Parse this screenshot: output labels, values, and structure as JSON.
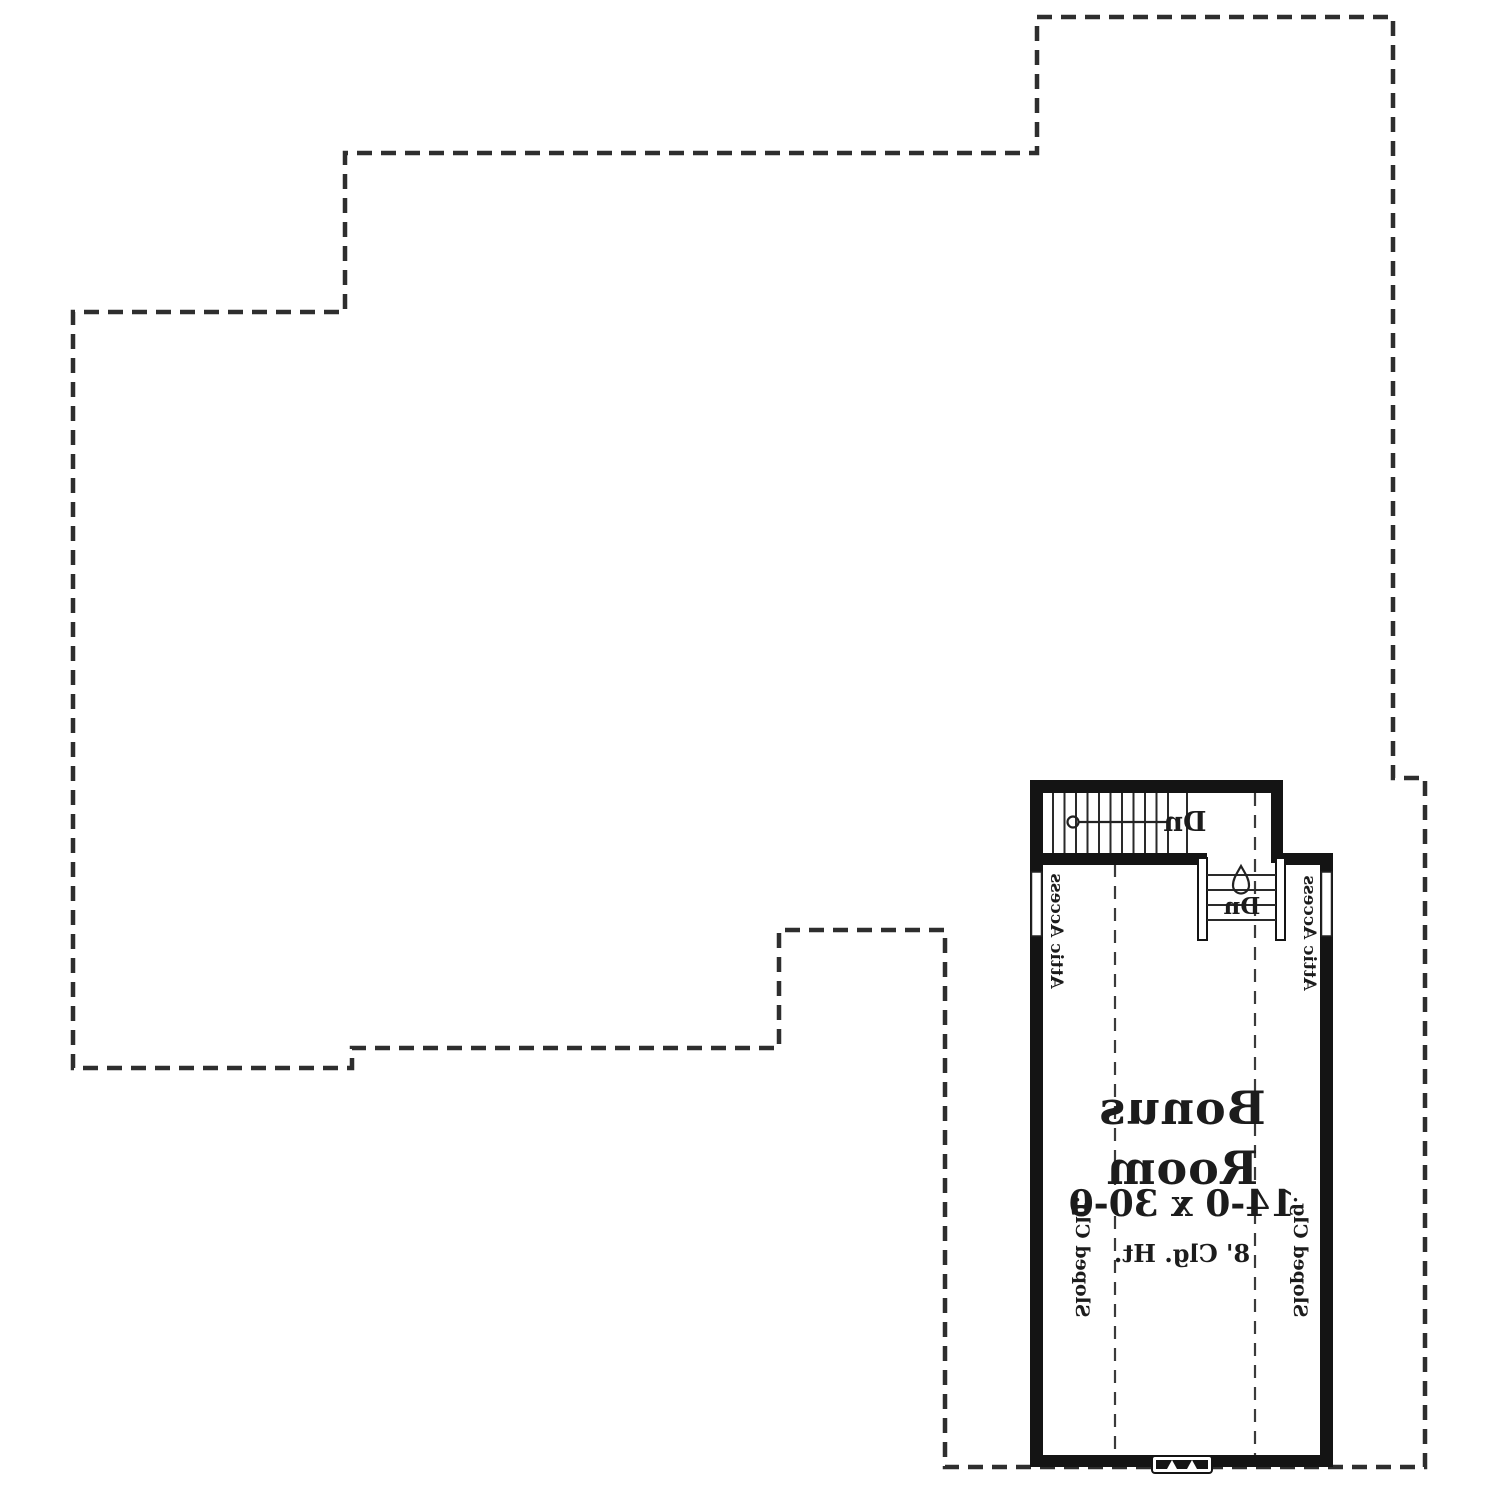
{
  "plan": {
    "room": {
      "name_line1": "Bonus",
      "name_line2": "Room",
      "dimensions": "14-0 x 30-0",
      "ceiling_height": "8' Clg. Ht."
    },
    "labels": {
      "sloped_ceiling_left": "Sloped Clg.",
      "sloped_ceiling_right": "Sloped Clg.",
      "attic_access_left": "Attic Access",
      "attic_access_right": "Attic Access",
      "stair_down_main": "Dn",
      "stair_down_return": "Dn"
    },
    "colors": {
      "wall": "#141414",
      "dashed_outline": "#2e2e2e",
      "text": "#1c1c1c",
      "background": "#ffffff"
    },
    "notes": {
      "orientation": "mirrored-plan"
    }
  }
}
